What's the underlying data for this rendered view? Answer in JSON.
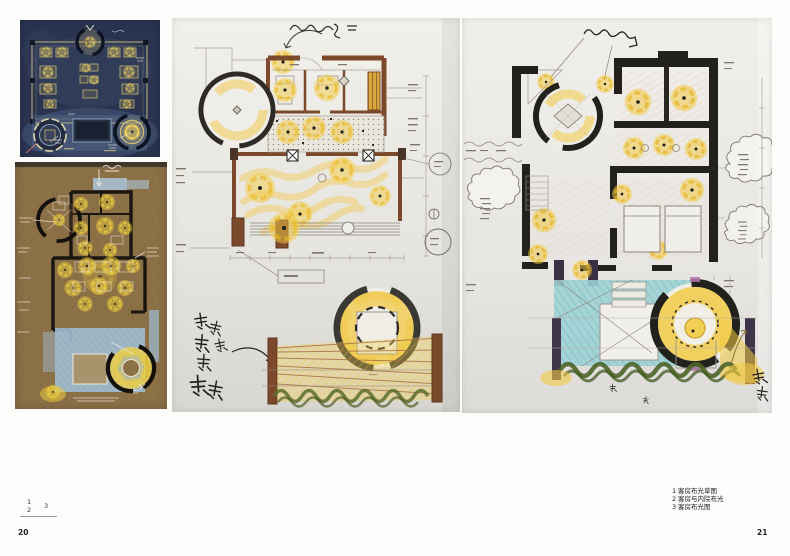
{
  "page": {
    "left_page_number": "20",
    "right_page_number": "21"
  },
  "figure_key": {
    "one": "1",
    "two": "2",
    "three": "3"
  },
  "captions": [
    {
      "num": "1",
      "text": "客房布光草图"
    },
    {
      "num": "2",
      "text": "客房与内院布光"
    },
    {
      "num": "3",
      "text": "客房布光图"
    }
  ],
  "figures": [
    {
      "id": "night-lighting-sketch",
      "description": "dark blue night-time guest room lighting sketch"
    },
    {
      "id": "kraft-paper-sketch",
      "description": "guest room and courtyard lighting sketch on kraft paper"
    },
    {
      "id": "lighting-plan-sketch",
      "description": "guest room lighting sketch plan with yellow light pools"
    },
    {
      "id": "lighting-plan-final",
      "description": "guest room lighting plan with pool and annotations"
    }
  ],
  "colors": {
    "accent_yellow": "#f2c84b",
    "night_navy": "#2a3450",
    "kraft_brown": "#8c7046",
    "wall_sienna": "#7c4a2b",
    "wall_black": "#23211c",
    "pool_cyan": "#9fd2d4",
    "pool_blue": "#9cb8cd",
    "hedge_green": "#4d6428"
  }
}
